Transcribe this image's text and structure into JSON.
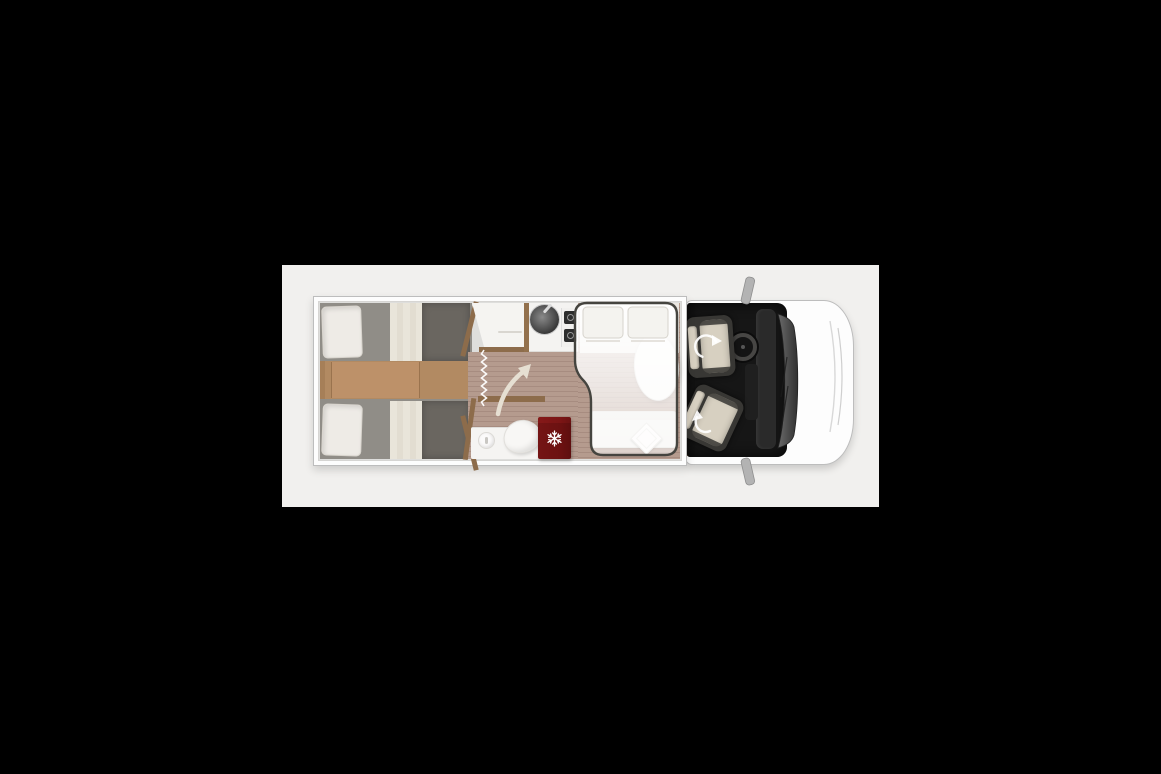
{
  "meta": {
    "scene_title": "Motorhome floor plan — top-down view",
    "description": "Top view layout drawing of a semi-integrated motorhome: twin single beds at the rear, central washroom with shower, toilet and fridge, kitchen block with sink and two-burner hob, drop-down double bed over the dinette, and driver cab with two swivel seats."
  },
  "palette": {
    "page_bg": "#000000",
    "panel_bg": "#f1f0ee",
    "body_white": "#fdfdfd",
    "body_outline": "#bdbdbd",
    "interior_bg": "#dededc",
    "wood": "#b28a62",
    "wood_step": "#bd9169",
    "wood_trim": "#8d6c4b",
    "plank": "#b59b8e",
    "plank_line": "#a78c80",
    "mattress_gray": "#908d87",
    "mattress_dark": "#6a6660",
    "bedding_cream": "#e9e5da",
    "white_soft": "#f5f4f1",
    "fridge_red": "#a84444",
    "fridge_red_light": "#c05353",
    "cab_black": "#161616",
    "seat_dark": "#383734",
    "seat_beige": "#d7d0c1",
    "dash_dark": "#2a2a2a",
    "glass_dark": "#303030",
    "glass_light": "#6a6a6a",
    "arrow_cream": "#e6dfd2",
    "mirror_gray": "#b3b3b3",
    "snowflake_white": "#ffffff"
  },
  "regions": {
    "panel": {
      "title": "Floor plan image panel"
    },
    "vehicle": {
      "title": "Motorhome top view"
    },
    "rear_bedroom": {
      "title": "Rear twin single beds"
    },
    "bed_top": {
      "title": "Single bed (left side)"
    },
    "bed_bottom": {
      "title": "Single bed (right side)"
    },
    "walkway": {
      "title": "Wooden step between beds"
    },
    "wardrobe": {
      "title": "Wardrobe cabinet"
    },
    "kitchen": {
      "title": "Kitchen block with sink and hob"
    },
    "shower": {
      "title": "Shower with curtain (zigzag)"
    },
    "bathroom": {
      "title": "Washroom with toilet and basin"
    },
    "fridge": {
      "title": "Fridge / freezer"
    },
    "dinette": {
      "title": "Dinette with table and bench"
    },
    "drop_down_bed": {
      "title": "Drop-down double bed (shown transparent)"
    },
    "cab": {
      "title": "Driver cab with swivel seats"
    },
    "hood": {
      "title": "Vehicle front / bonnet"
    }
  },
  "icons": [
    {
      "name": "snowflake-icon",
      "meaning": "refrigerator / freezer compartment"
    },
    {
      "name": "door-swing-arrow-icon",
      "meaning": "bathroom door swing direction"
    },
    {
      "name": "swivel-arrow-icon",
      "meaning": "rotating cab seat"
    },
    {
      "name": "shower-curtain-zigzag",
      "meaning": "shower curtain line"
    }
  ],
  "furniture": {
    "pillows_rear": 2,
    "pillows_drop_down_bed": 2,
    "cab_seats": 2,
    "burners_on_hob": 2
  }
}
